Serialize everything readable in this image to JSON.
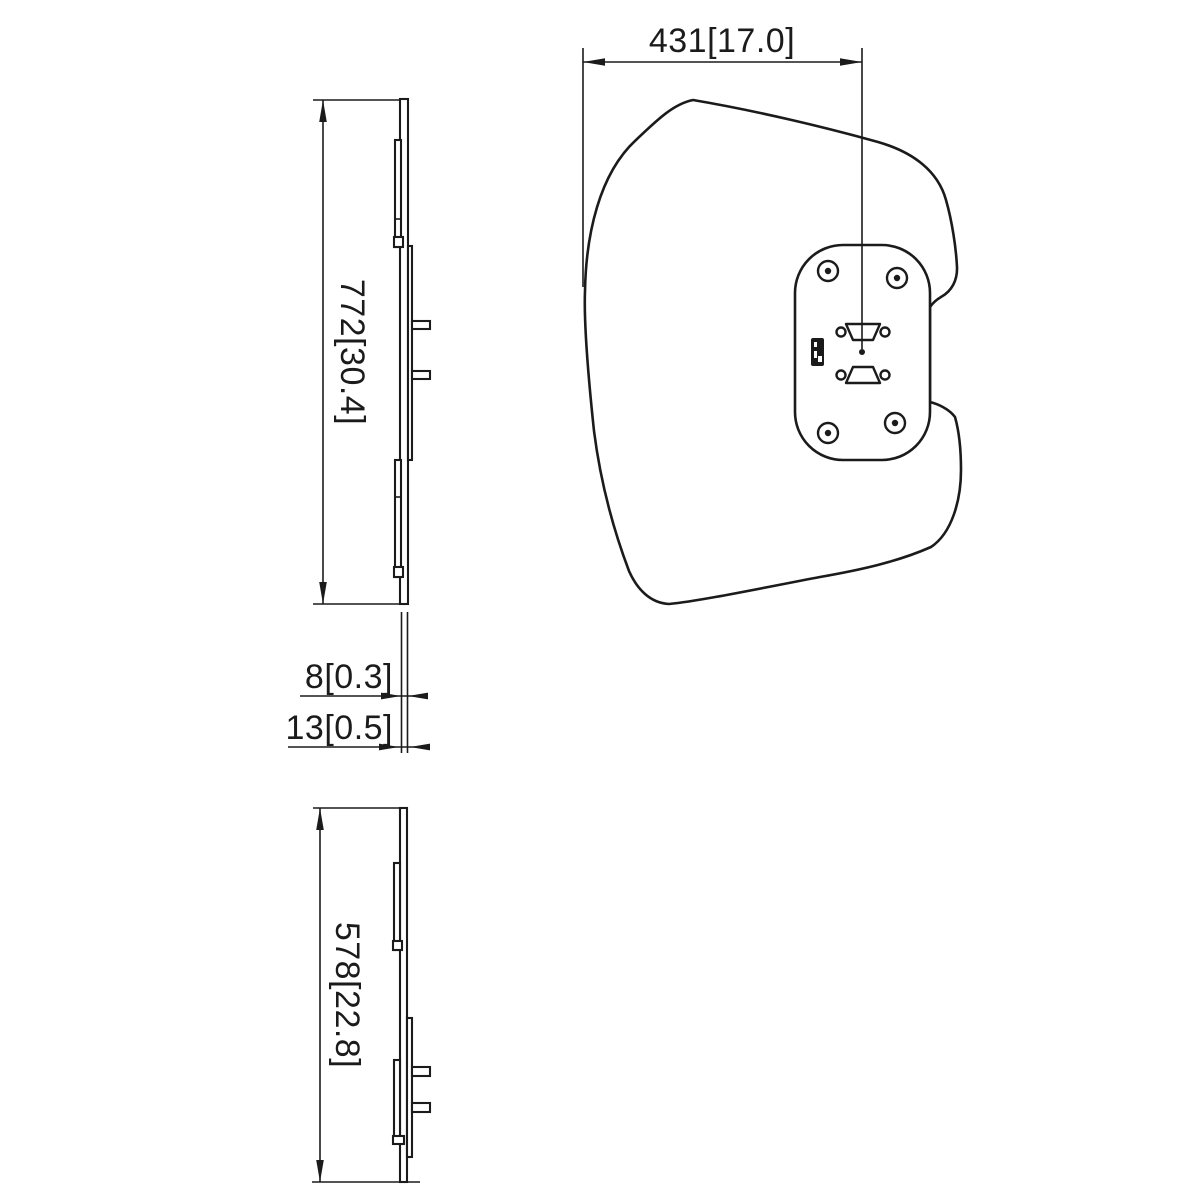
{
  "drawing": {
    "dims": {
      "front_width": "431[17.0]",
      "side_top_height": "772[30.4]",
      "thickness_inner": "8[0.3]",
      "thickness_outer": "13[0.5]",
      "side_bottom_height": "578[22.8]"
    },
    "colors": {
      "line": "#1b1b1b",
      "background": "#ffffff"
    }
  }
}
